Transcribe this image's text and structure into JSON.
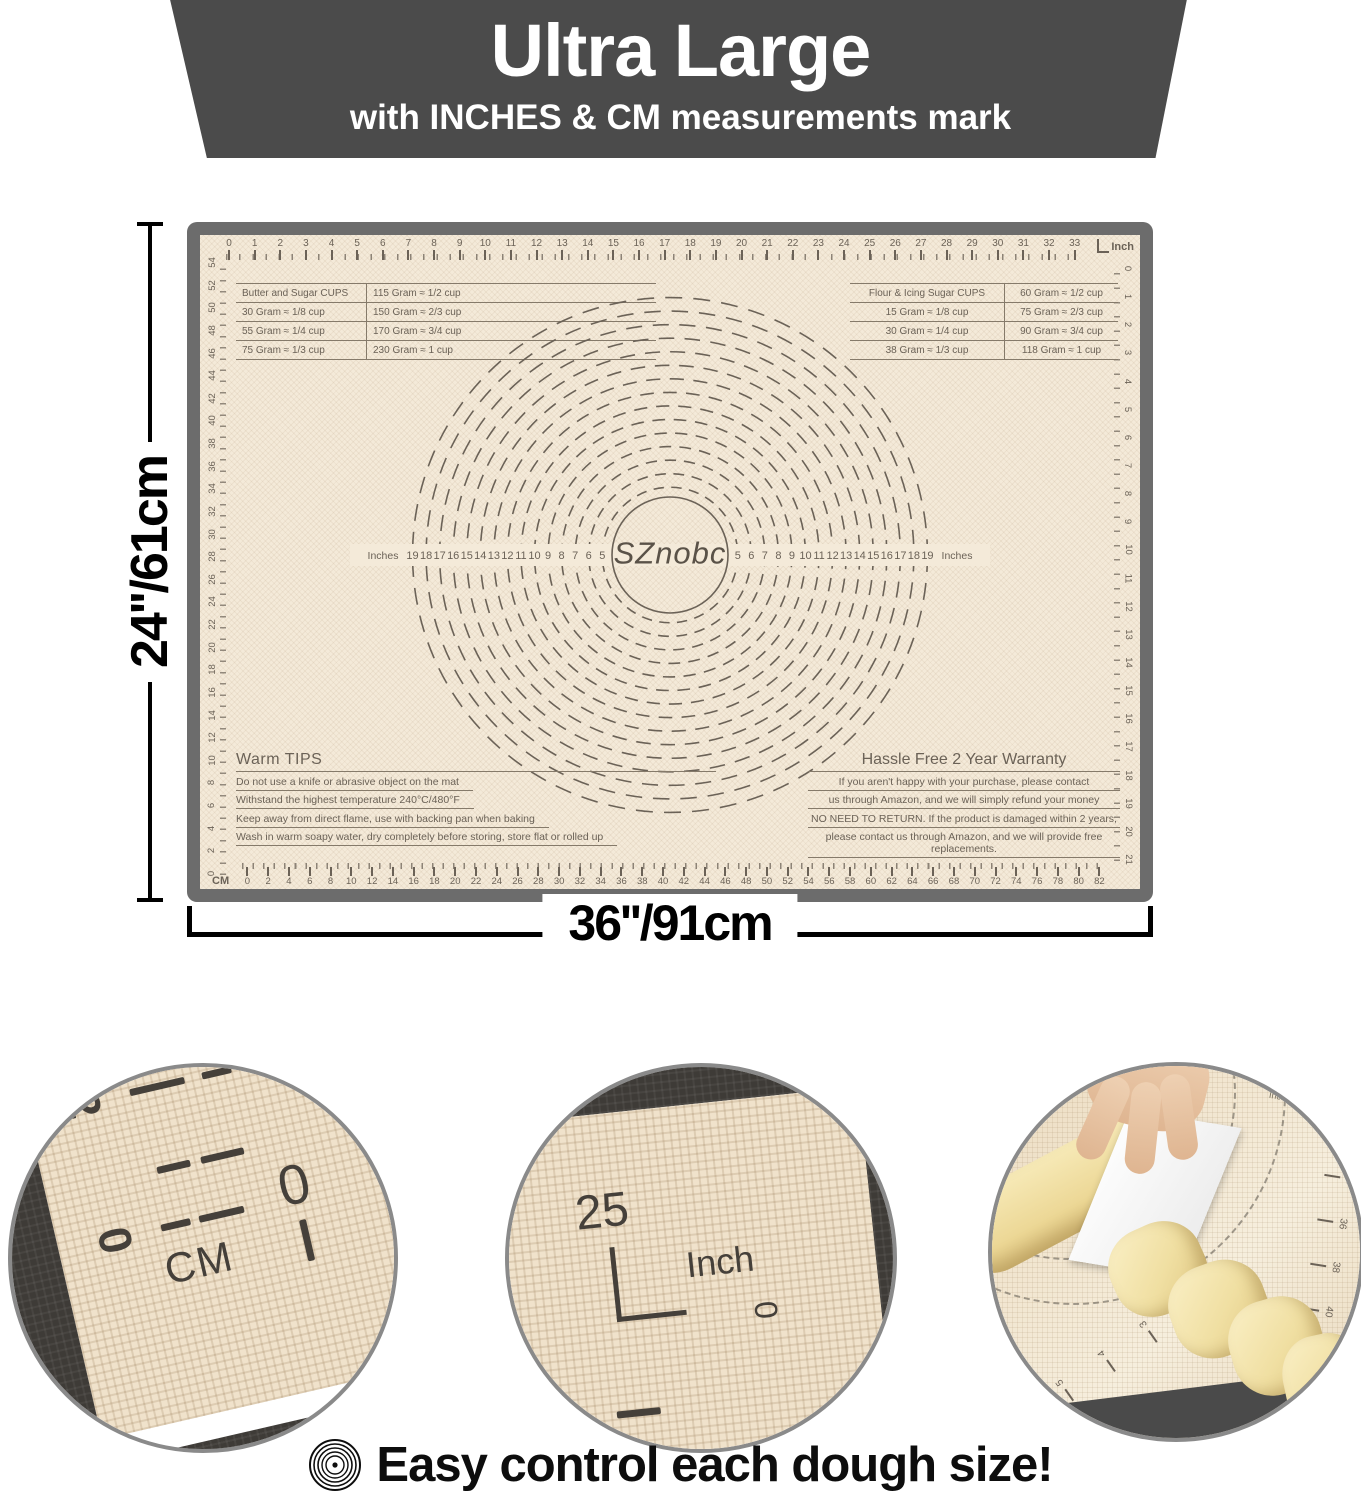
{
  "banner": {
    "title": "Ultra Large",
    "subtitle": "with INCHES & CM measurements mark"
  },
  "dimensions": {
    "height_label": "24''/61cm",
    "width_label": "36''/91cm"
  },
  "mat": {
    "brand": "SZnobc",
    "top_ruler": {
      "unit_label": "Inch",
      "numbers": [
        0,
        1,
        2,
        3,
        4,
        5,
        6,
        7,
        8,
        9,
        10,
        11,
        12,
        13,
        14,
        15,
        16,
        17,
        18,
        19,
        20,
        21,
        22,
        23,
        24,
        25,
        26,
        27,
        28,
        29,
        30,
        31,
        32,
        33
      ]
    },
    "bottom_ruler": {
      "unit_label": "CM",
      "numbers": [
        0,
        2,
        4,
        6,
        8,
        10,
        12,
        14,
        16,
        18,
        20,
        22,
        24,
        26,
        28,
        30,
        32,
        34,
        36,
        38,
        40,
        42,
        44,
        46,
        48,
        50,
        52,
        54,
        56,
        58,
        60,
        62,
        64,
        66,
        68,
        70,
        72,
        74,
        76,
        78,
        80,
        82
      ]
    },
    "left_ruler": {
      "numbers": [
        54,
        52,
        50,
        48,
        46,
        44,
        42,
        40,
        38,
        36,
        34,
        32,
        30,
        28,
        26,
        24,
        22,
        20,
        18,
        16,
        14,
        12,
        10,
        8,
        6,
        4,
        2,
        0
      ]
    },
    "right_ruler": {
      "numbers": [
        0,
        1,
        2,
        3,
        4,
        5,
        6,
        7,
        8,
        9,
        10,
        11,
        12,
        13,
        14,
        15,
        16,
        17,
        18,
        19,
        20,
        21
      ]
    },
    "tables": {
      "butter": {
        "rows": [
          [
            "Butter and Sugar CUPS",
            "115 Gram  ≈  1/2 cup"
          ],
          [
            "30 Gram  ≈  1/8 cup",
            "150 Gram  ≈  2/3 cup"
          ],
          [
            "55 Gram  ≈  1/4 cup",
            "170 Gram  ≈  3/4 cup"
          ],
          [
            "75 Gram  ≈  1/3 cup",
            "230 Gram  ≈  1 cup"
          ]
        ]
      },
      "flour": {
        "rows": [
          [
            "Flour & Icing Sugar CUPS",
            "60 Gram  ≈  1/2 cup"
          ],
          [
            "15 Gram  ≈  1/8 cup",
            "75 Gram  ≈  2/3 cup"
          ],
          [
            "30 Gram  ≈  1/4 cup",
            "90 Gram  ≈  3/4 cup"
          ],
          [
            "38 Gram  ≈  1/3 cup",
            "118 Gram  ≈  1 cup"
          ]
        ]
      }
    },
    "circles": {
      "axis_label": "Inches",
      "diameters": [
        5,
        6,
        7,
        8,
        9,
        10,
        11,
        12,
        13,
        14,
        15,
        16,
        17,
        18,
        19
      ]
    },
    "tips": {
      "title": "Warm TIPS",
      "lines": [
        "Do not use a knife or abrasive object on the mat",
        "Withstand the highest temperature 240°C/480°F",
        "Keep away from direct flame, use with backing pan when baking",
        "Wash in warm soapy water, dry completely before storing, store flat or rolled up"
      ]
    },
    "warranty": {
      "title": "Hassle Free 2 Year Warranty",
      "lines": [
        "If you aren't happy with your purchase, please contact",
        "us through Amazon,  and we will simply refund your money",
        "NO NEED TO RETURN. If the product is damaged within 2 years,",
        "please contact us through Amazon, and we will provide free replacements."
      ]
    }
  },
  "insets": {
    "cm_detail": {
      "left_numbers": [
        "2",
        "0"
      ],
      "unit": "CM",
      "bottom_number": "0"
    },
    "inch_detail": {
      "number": "25",
      "unit": "Inch",
      "zero": "0"
    },
    "photo": {
      "label": "Inches",
      "right_numbers": [
        32,
        34,
        36,
        38,
        40,
        42,
        44
      ],
      "bottom_numbers": [
        6,
        5,
        4,
        3,
        2
      ]
    }
  },
  "caption": {
    "text": "Easy control each dough size!"
  },
  "colors": {
    "banner": "#4b4b4b",
    "mat_surface": "#f4ead9",
    "mat_frame": "#6c6c6c",
    "mat_ink": "#6b6257",
    "inset_ring": "#8a8a8a",
    "caption_text": "#0d0d0d",
    "dough": "#f0dfa2"
  }
}
